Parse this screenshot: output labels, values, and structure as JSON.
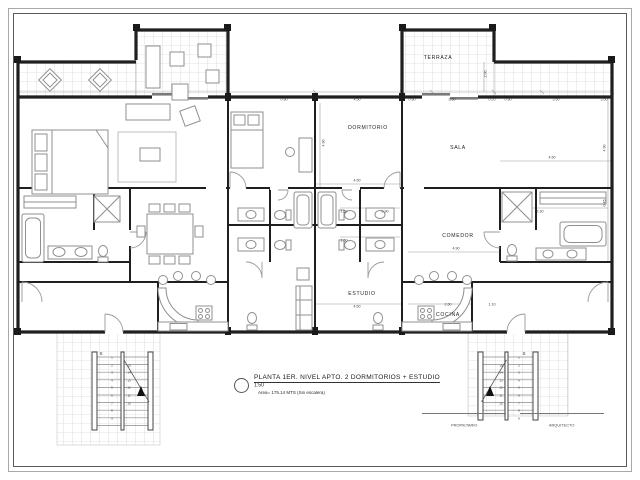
{
  "drawing_type": "architectural floor plan",
  "rooms": {
    "terraza": "TERRAZA",
    "dormitorio": "DORMITORIO",
    "sala": "SALA",
    "comedor": "COMEDOR",
    "estudio": "ESTUDIO",
    "cocina": "COCINA"
  },
  "title_block": {
    "title": "PLANTA 1ER. NIVEL APTO. 2 DORMITORIOS + ESTUDIO",
    "scale": "1:50",
    "area_note": "Area= 175.14 MTS (Sin escalera)"
  },
  "signatures": {
    "left": "PROPIETARIO",
    "right": "ARQUITECTO"
  },
  "stairs": {
    "direction_label": "S",
    "up_numbers": [
      "1",
      "2",
      "3",
      "4",
      "5",
      "6",
      "7",
      "8",
      "9"
    ],
    "down_numbers": [
      "15",
      "14",
      "13",
      "12",
      "11",
      "10"
    ]
  },
  "colors": {
    "wall": "#1f1f1f",
    "furniture_line": "#8f8f8f",
    "tile_line": "#c8c8c8",
    "dimension_line": "#999999",
    "text": "#1d1d1d"
  },
  "dimensions": [
    {
      "t": "0.90",
      "x": 412,
      "y": 100
    },
    {
      "t": "3.50",
      "x": 452,
      "y": 100
    },
    {
      "t": "0.20",
      "x": 492,
      "y": 100
    },
    {
      "t": "0.90",
      "x": 508,
      "y": 100
    },
    {
      "t": "3.50",
      "x": 556,
      "y": 100
    },
    {
      "t": "3.50",
      "x": 604,
      "y": 100
    },
    {
      "t": "2.00",
      "x": 486,
      "y": 74,
      "r": 1
    },
    {
      "t": "4.50",
      "x": 357,
      "y": 100
    },
    {
      "t": "0.90",
      "x": 284,
      "y": 100
    },
    {
      "t": "4.90",
      "x": 324,
      "y": 143,
      "r": 1
    },
    {
      "t": "4.50",
      "x": 357,
      "y": 181
    },
    {
      "t": "4.50",
      "x": 552,
      "y": 158
    },
    {
      "t": "4.90",
      "x": 605,
      "y": 148,
      "r": 1
    },
    {
      "t": "0.45",
      "x": 605,
      "y": 203,
      "r": 1
    },
    {
      "t": "4.90",
      "x": 456,
      "y": 249
    },
    {
      "t": "4.50",
      "x": 357,
      "y": 307
    },
    {
      "t": "2.60",
      "x": 448,
      "y": 305
    },
    {
      "t": "1.10",
      "x": 492,
      "y": 305
    },
    {
      "t": "1.60",
      "x": 344,
      "y": 212
    },
    {
      "t": "0.90",
      "x": 385,
      "y": 212
    },
    {
      "t": "1.60",
      "x": 344,
      "y": 241
    },
    {
      "t": "2.30",
      "x": 540,
      "y": 212
    }
  ]
}
